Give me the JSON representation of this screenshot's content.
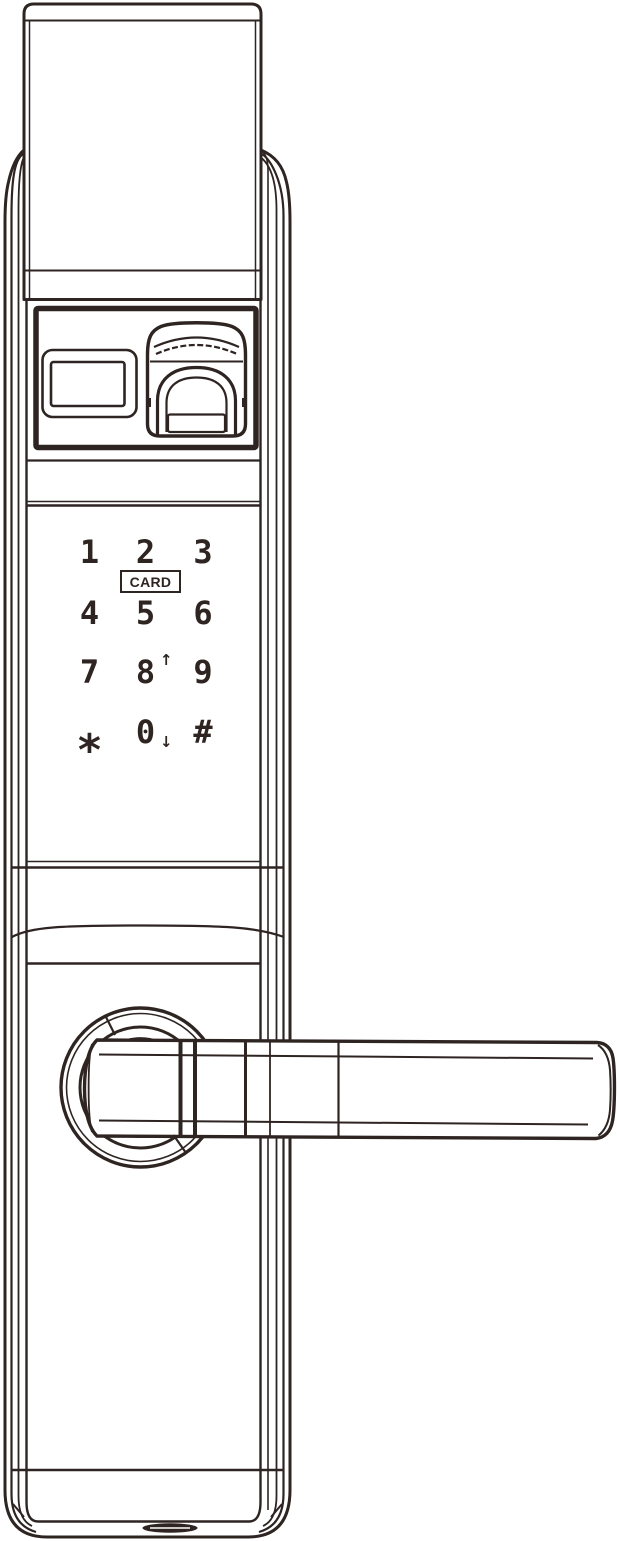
{
  "figure": {
    "subject": "smart door lock front view",
    "style": "black line art on white"
  },
  "colors": {
    "line": "#2e2522",
    "background": "#ffffff"
  },
  "lock": {
    "keypad": {
      "card_label": "CARD",
      "rows": [
        {
          "keys": [
            {
              "label": "1"
            },
            {
              "label": "2"
            },
            {
              "label": "3"
            }
          ]
        },
        {
          "keys": [
            {
              "label": "4"
            },
            {
              "label": "5"
            },
            {
              "label": "6"
            }
          ]
        },
        {
          "keys": [
            {
              "label": "7"
            },
            {
              "label": "8",
              "arrow_icon": "arrow-up-icon",
              "arrow_glyph": "↑"
            },
            {
              "label": "9"
            }
          ]
        },
        {
          "keys": [
            {
              "label": "*"
            },
            {
              "label": "0",
              "arrow_icon": "arrow-down-icon",
              "arrow_glyph": "↓"
            },
            {
              "label": "#"
            }
          ]
        }
      ]
    },
    "parts": {
      "top_cover": "sliding-cover",
      "reader_panel": "reader-panel",
      "card_window": "card-display-window",
      "fingerprint_sensor": "fingerprint-sensor",
      "rosette": "handle-rosette",
      "handle": "lever-handle",
      "bottom_slot": "charging-port-slot"
    }
  }
}
